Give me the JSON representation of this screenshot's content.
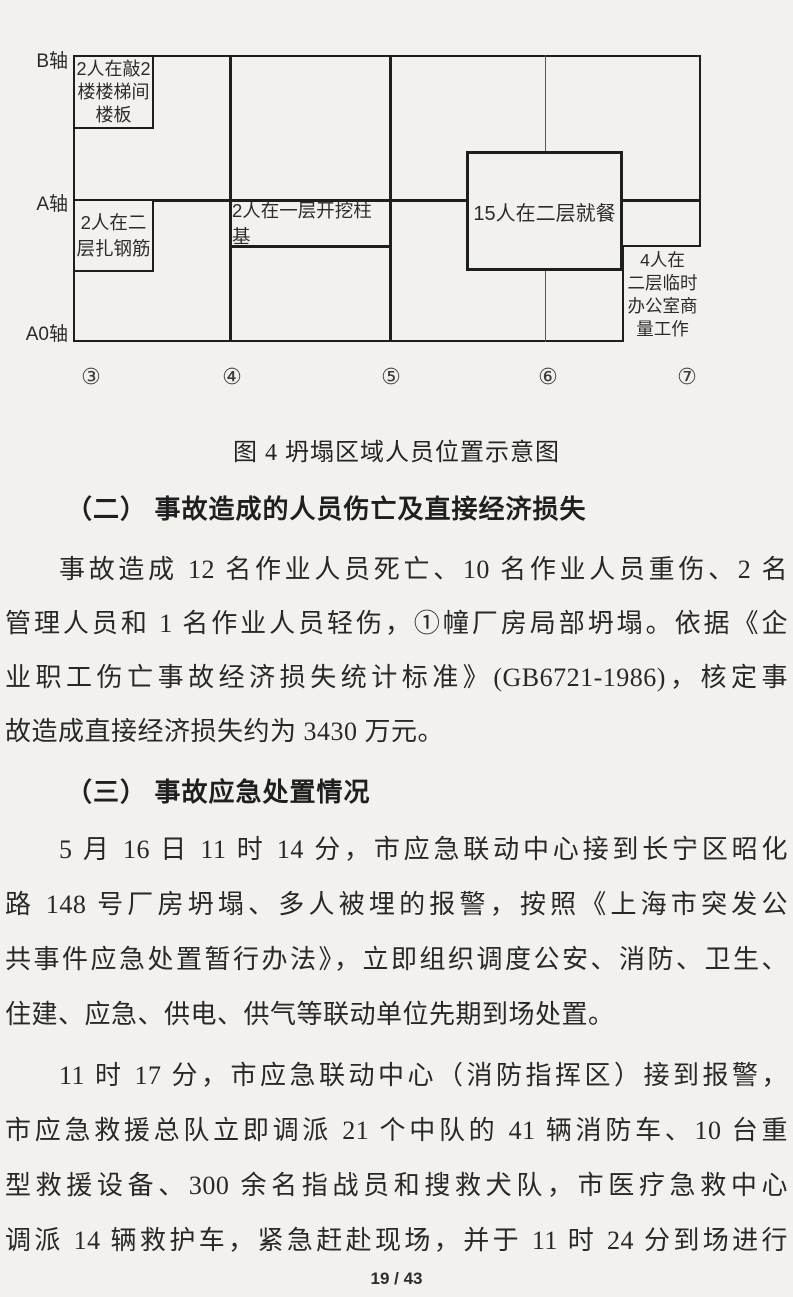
{
  "page": {
    "footer": "19 / 43"
  },
  "diagram": {
    "caption": "图 4 坍塌区域人员位置示意图",
    "axes": {
      "b": "B轴",
      "a": "A轴",
      "a0": "A0轴"
    },
    "columns": [
      "③",
      "④",
      "⑤",
      "⑥",
      "⑦"
    ],
    "annotations": {
      "knock": "2人在敲2\n楼楼梯间\n楼板",
      "rebar": "2人在二\n层扎钢筋",
      "dig": "2人在一层开挖柱基",
      "dining": "15人在二层就餐",
      "office": "4人在\n二层临时\n办公室商\n量工作"
    }
  },
  "sections": {
    "heading2": "（二） 事故造成的人员伤亡及直接经济损失",
    "p1": [
      "事故造成 12 名作业人员死亡、10 名作业人员重伤、2 名",
      "管理人员和 1 名作业人员轻伤，①幢厂房局部坍塌。依据《企",
      "业职工伤亡事故经济损失统计标准》(GB6721-1986)，核定事",
      "故造成直接经济损失约为 3430 万元。"
    ],
    "heading3": "（三） 事故应急处置情况",
    "p2": [
      "5 月 16 日 11 时 14 分，市应急联动中心接到长宁区昭化",
      "路 148 号厂房坍塌、多人被埋的报警，按照《上海市突发公",
      "共事件应急处置暂行办法》，立即组织调度公安、消防、卫生、",
      "住建、应急、供电、供气等联动单位先期到场处置。"
    ],
    "p3": [
      "11 时 17 分，市应急联动中心（消防指挥区）接到报警，",
      "市应急救援总队立即调派 21 个中队的 41 辆消防车、10 台重",
      "型救援设备、300 余名指战员和搜救犬队，市医疗急救中心",
      "调派 14 辆救护车，紧急赶赴现场，并于 11 时 24 分到场进行"
    ]
  }
}
